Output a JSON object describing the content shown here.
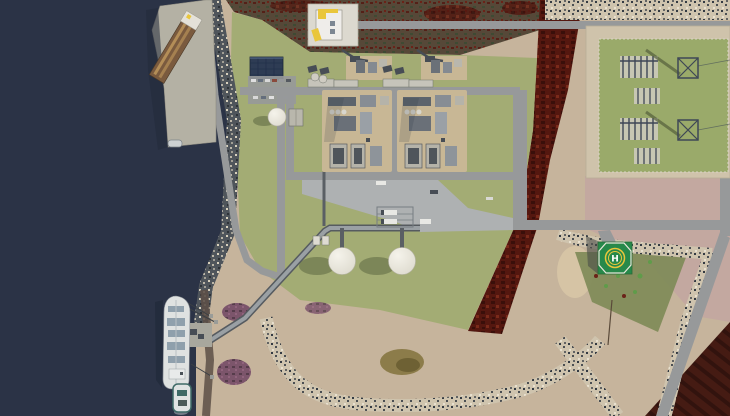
{
  "scene": {
    "description": "Aerial 3D rendering of a coastal LNG terminal: ship berth and quay on dark water at left, two liquefaction process trains and two spherical storage tanks on a green plot in the center, an electrical substation on a green pad at upper right, a helipad marked H, gray service roads, rock riprap shorelines, sandy beach with purple scrub, and dark-red vegetation fields",
    "helipad_label": "H"
  },
  "colors": {
    "water": "#2b3346",
    "waterShadow": "#222a3b",
    "sand": "#c6b49c",
    "pink": "#c3a8a0",
    "grass": "#a3ac74",
    "subgrass": "#9aaa6a",
    "scrub": "#564838",
    "redveg": "#54170f",
    "redvegDark": "#3a0f0a",
    "redfield": "#451b13",
    "riprapDark": "#4f555b",
    "riprapLight": "#cfc4ae",
    "stoneLight": "#d8d0bc",
    "stoneDark": "#343b43",
    "road": "#97999a",
    "apron": "#aeb1b2",
    "concrete": "#b4b1a4",
    "concrete2": "#a8a79d",
    "padTan": "#c8b795",
    "trestle": "#9aa0a4",
    "trestleDark": "#5a5f64",
    "solar": "#2e3c54",
    "warehouse": "#7a5a3e",
    "warehouseStripe": "#c29a5e",
    "shipHull": "#dfe2e1",
    "deckDetail": "#8fa0ac",
    "tugTeal": "#3e6a66",
    "tank": "#dedbcf",
    "tankHi": "#f5f3eb",
    "shadow": "#55603c",
    "helipad": "#27894a",
    "yellow": "#e9c63b",
    "equip": "#474d55",
    "equipLight": "#c6c4ba",
    "subPad": "#cfc3ab",
    "subEquip": "#3e4756",
    "pond": "#8c7c4a",
    "purple": "#744a66",
    "scrubGreen": "#7d8a57",
    "treeGreen": "#5f9c4a"
  }
}
